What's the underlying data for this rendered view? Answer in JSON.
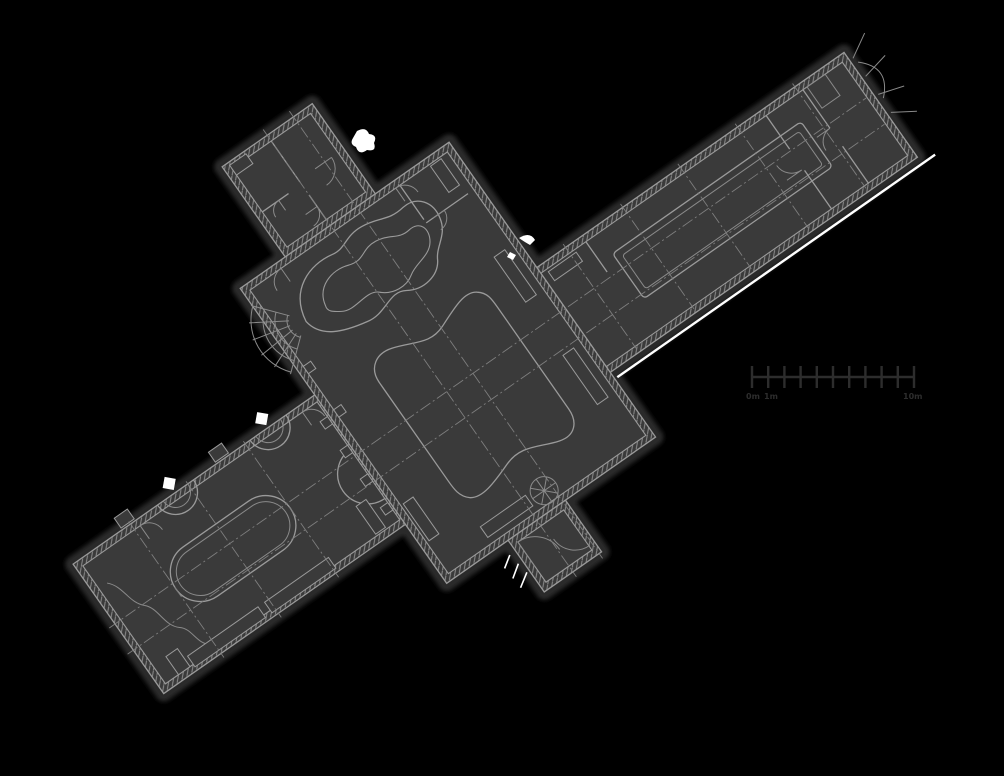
{
  "canvas": {
    "width": 1004,
    "height": 776
  },
  "colors": {
    "background": "#000000",
    "building_fill": "#3a3a3a",
    "line": "#9a9a9a",
    "line_minor": "#8a8a8a",
    "axis_line": "#7e7e7e",
    "halo": "#2a2a2a",
    "scalebar": "#2d2d2d",
    "accent": "#ffffff"
  },
  "plan": {
    "rotation_deg": -35,
    "components": [
      "lower-left-wing-hall",
      "central-hall",
      "upper-right-wing-hall",
      "top-left-annex",
      "entrance-vestibule",
      "main-pool",
      "grotto-pool",
      "oval-pool",
      "long-pool",
      "fan-stair",
      "spiral-stair",
      "apse-niches",
      "axis-centerlines",
      "hatched-walls"
    ]
  },
  "scale_bar": {
    "start_label": "0m",
    "second_label": "1m",
    "end_label": "10m",
    "segments": 10
  }
}
